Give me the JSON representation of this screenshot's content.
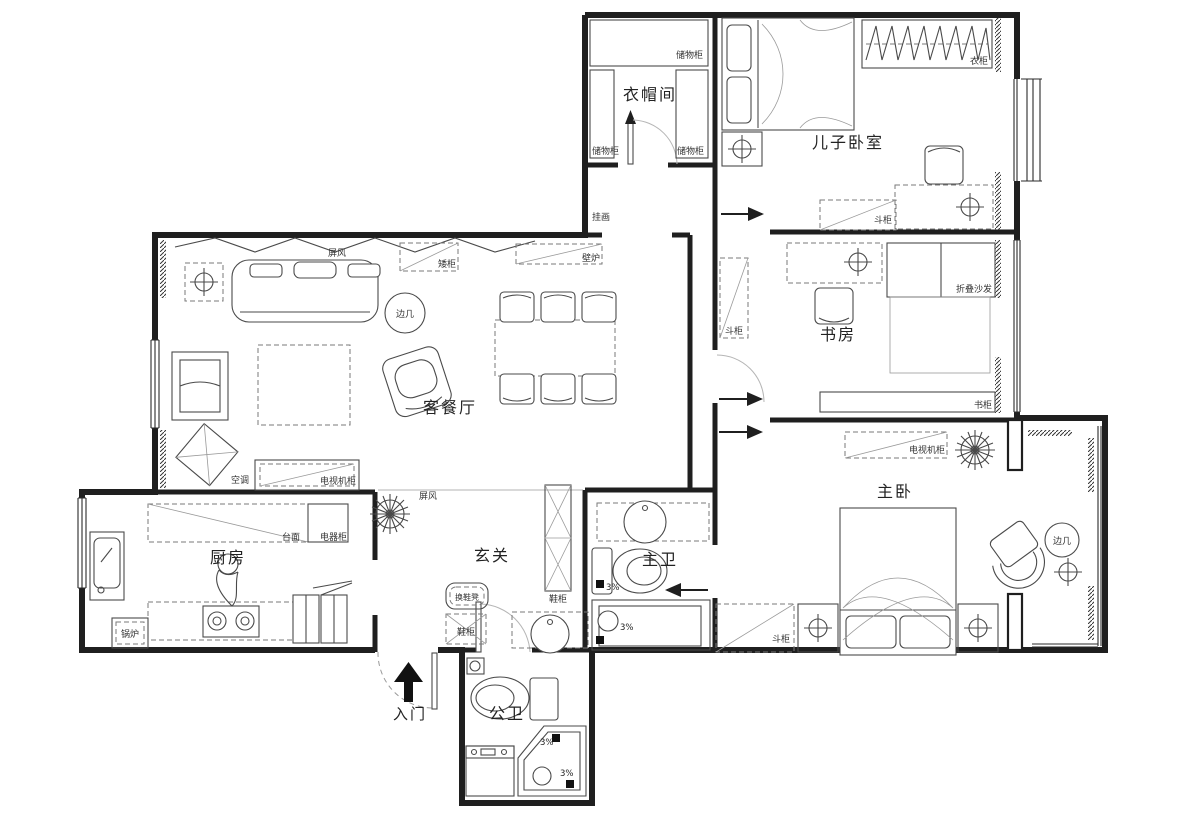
{
  "rooms": {
    "cloakroom": "衣帽间",
    "son_bedroom": "儿子卧室",
    "study": "书房",
    "living_dining": "客餐厅",
    "master_bedroom": "主卧",
    "kitchen": "厨房",
    "entry_hall": "玄关",
    "master_bath": "主卫",
    "guest_bath": "公卫",
    "entrance": "入门"
  },
  "furniture": {
    "storage_cabinet": "储物柜",
    "wardrobe": "衣柜",
    "chest_of_drawers": "斗柜",
    "hanging_picture": "挂画",
    "folding_screen": "屏风",
    "low_cabinet": "矮柜",
    "fireplace": "壁炉",
    "side_table": "边几",
    "air_conditioner": "空调",
    "tv_cabinet": "电视机柜",
    "countertop": "台面",
    "appliance_cabinet": "电器柜",
    "boiler": "锅炉",
    "shoe_bench": "换鞋凳",
    "shoe_cabinet": "鞋柜",
    "folding_sofa": "折叠沙发",
    "bookcase": "书柜"
  },
  "annotations": {
    "slope": "3%"
  },
  "colors": {
    "wall": "#1f1f1f",
    "furniture": "#4a4a4a",
    "text": "#222222",
    "background": "#ffffff"
  }
}
